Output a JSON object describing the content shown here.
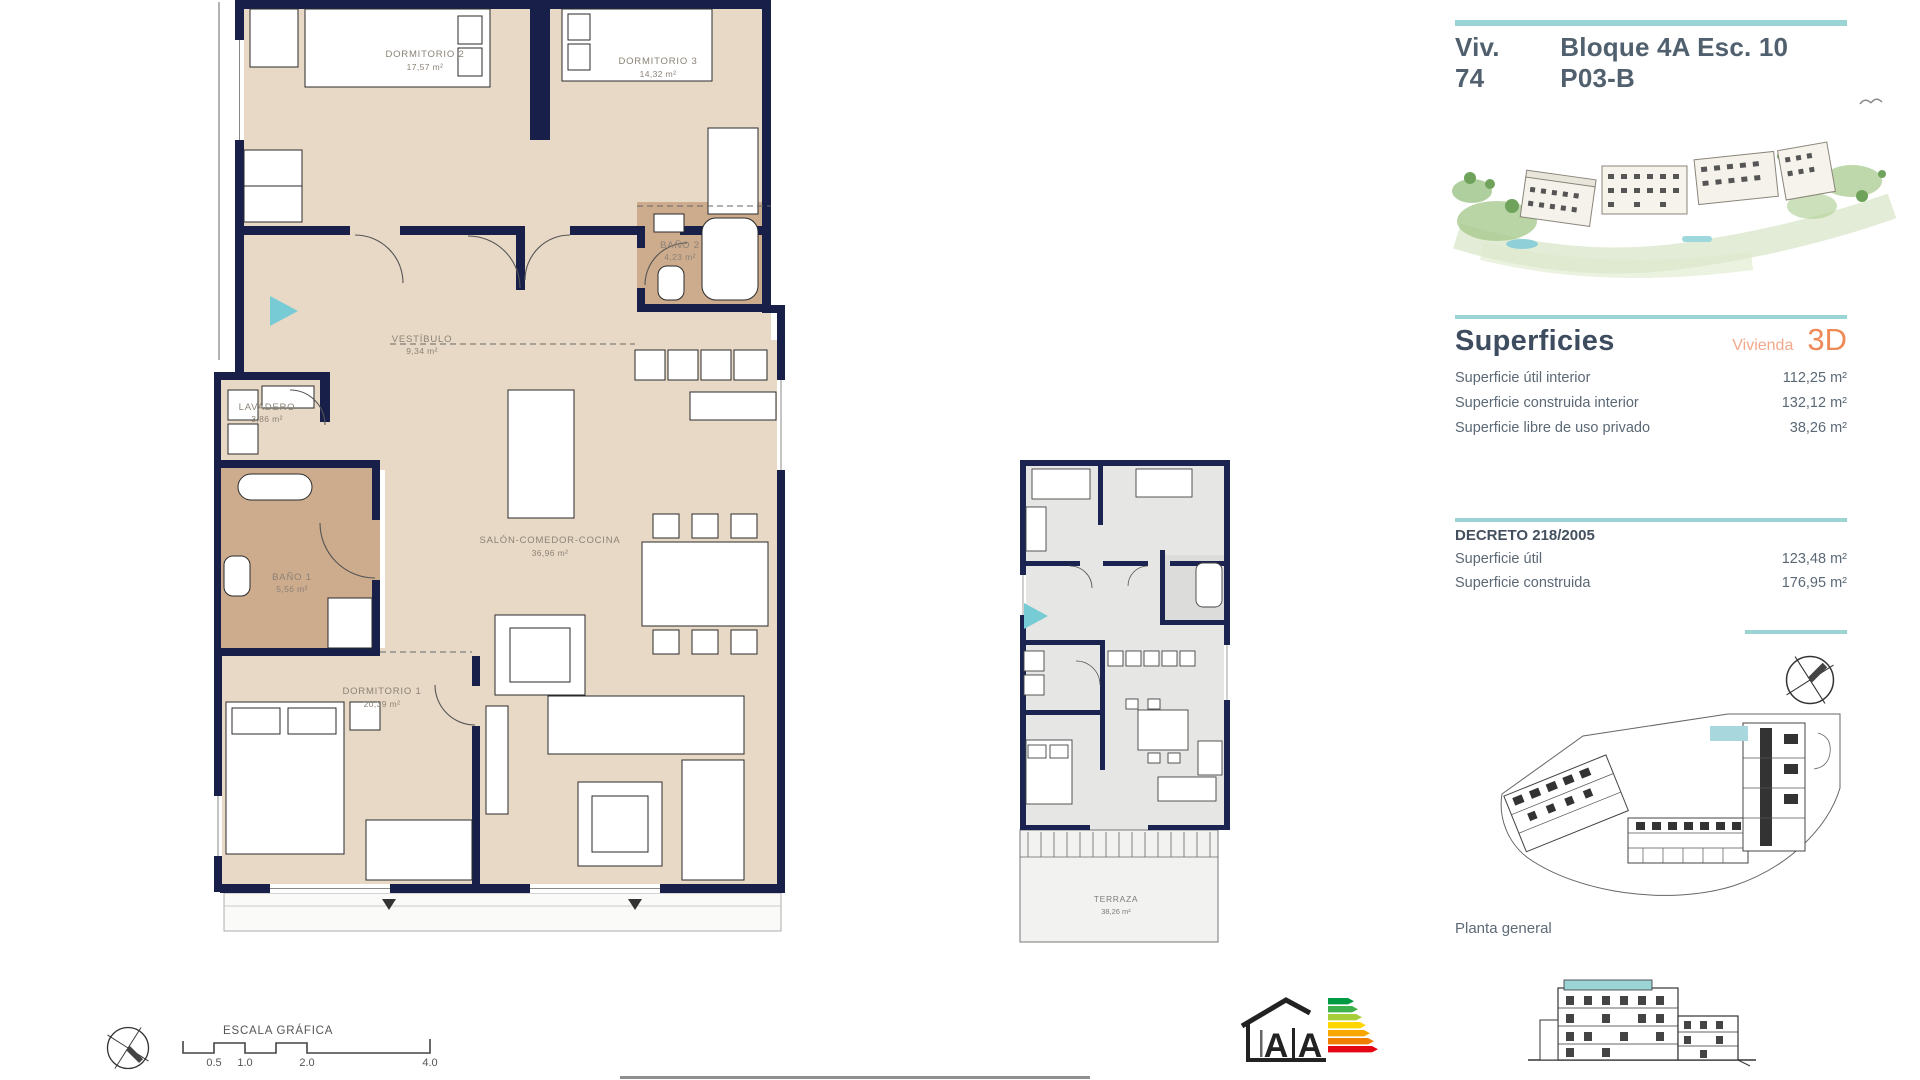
{
  "header": {
    "unit": "Viv. 74",
    "block": "Bloque 4A Esc. 10 P03-B"
  },
  "superficies": {
    "heading": "Superficies",
    "type_label": "Vivienda",
    "view_label": "3D",
    "rows": [
      {
        "label": "Superficie útil interior",
        "value": "112,25 m²"
      },
      {
        "label": "Superficie construida interior",
        "value": "132,12 m²"
      },
      {
        "label": "Superficie libre de uso privado",
        "value": "38,26 m²"
      }
    ]
  },
  "decreto": {
    "heading": "DECRETO 218/2005",
    "rows": [
      {
        "label": "Superficie útil",
        "value": "123,48 m²"
      },
      {
        "label": "Superficie construida",
        "value": "176,95 m²"
      }
    ]
  },
  "floor_plan": {
    "rooms": [
      {
        "name": "DORMITORIO 2",
        "area": "17,57 m²"
      },
      {
        "name": "DORMITORIO 3",
        "area": "14,32 m²"
      },
      {
        "name": "BAÑO 2",
        "area": "4,23 m²"
      },
      {
        "name": "VESTÍBULO",
        "area": "9,34 m²"
      },
      {
        "name": "LAVADERO",
        "area": "3,86 m²"
      },
      {
        "name": "BAÑO 1",
        "area": "5,56 m²"
      },
      {
        "name": "SALÓN-COMEDOR-COCINA",
        "area": "36,96 m²"
      },
      {
        "name": "DORMITORIO 1",
        "area": "20,39 m²"
      }
    ]
  },
  "terrace_plan": {
    "name": "TERRAZA",
    "area": "38,26 m²"
  },
  "site_plan": {
    "caption": "Planta general"
  },
  "scale_bar": {
    "title": "ESCALA GRÁFICA",
    "ticks": [
      "0.5",
      "1.0",
      "2.0",
      "4.0"
    ]
  },
  "energy_label": {
    "letter_a1": "A",
    "letter_a2": "A"
  },
  "colors": {
    "teal": "#9ad4d4",
    "teal_arrow": "#76cbd4",
    "navy": "#18204a",
    "beige": "#e8d9c6",
    "bath": "#cdab8d",
    "salmon": "#f2a98b",
    "orange": "#ee8a58"
  }
}
